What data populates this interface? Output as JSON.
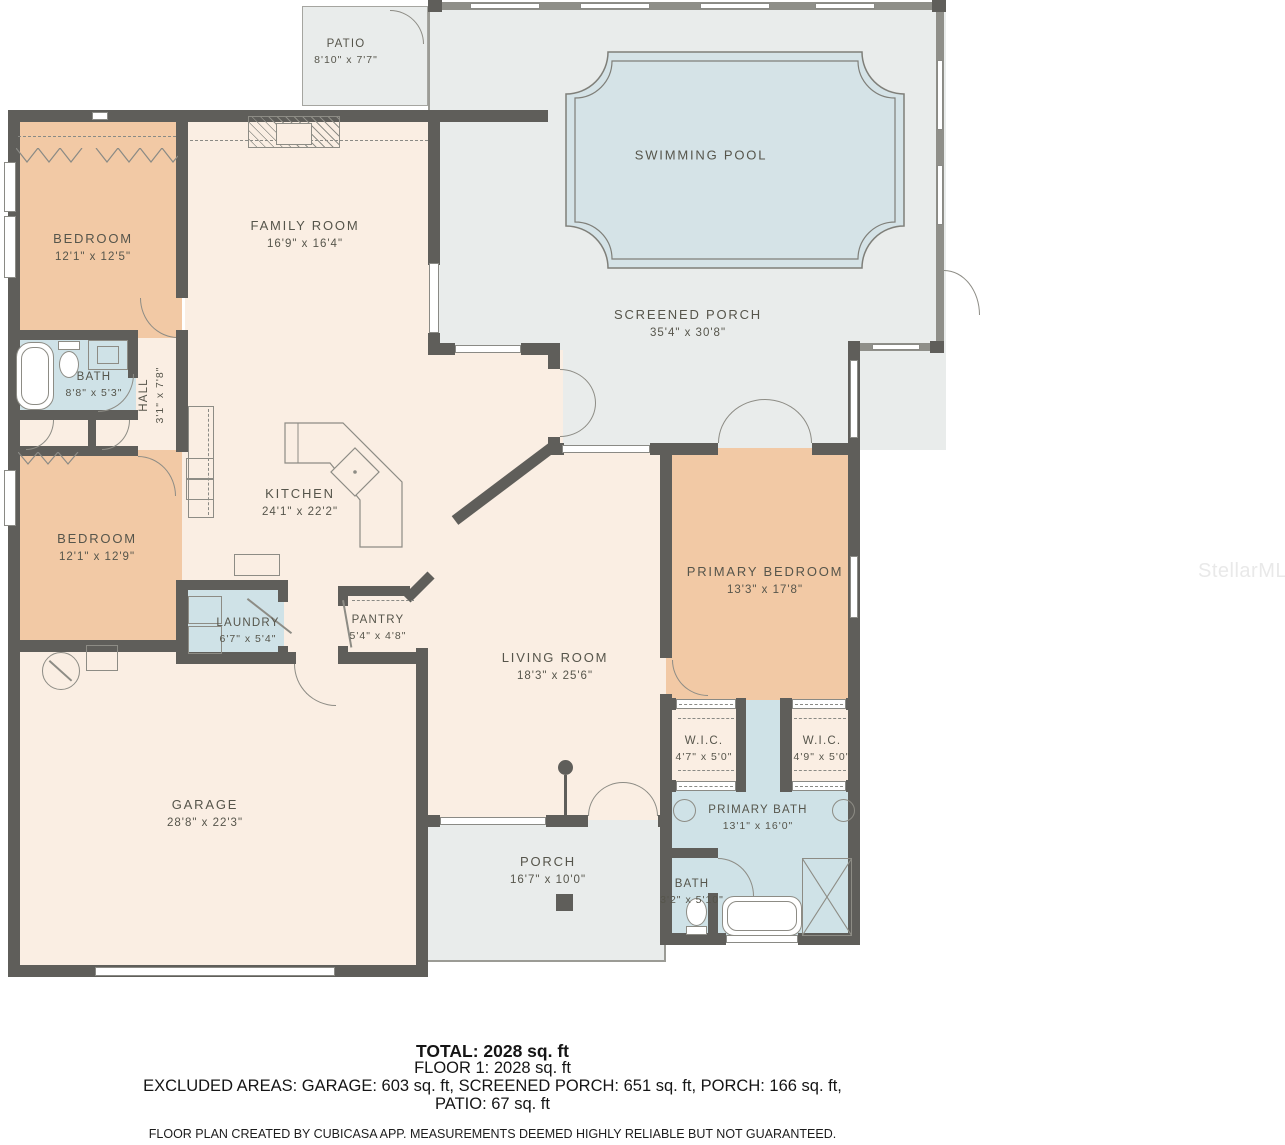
{
  "rooms": {
    "patio": {
      "name": "PATIO",
      "dims": "8'10\" x 7'7\""
    },
    "swimming_pool": {
      "name": "SWIMMING POOL"
    },
    "screened_porch": {
      "name": "SCREENED PORCH",
      "dims": "35'4\" x 30'8\""
    },
    "family_room": {
      "name": "FAMILY ROOM",
      "dims": "16'9\" x 16'4\""
    },
    "bedroom1": {
      "name": "BEDROOM",
      "dims": "12'1\" x 12'5\""
    },
    "bath1": {
      "name": "BATH",
      "dims": "8'8\" x 5'3\""
    },
    "hall": {
      "name": "HALL",
      "dims": "3'1\" x 7'8\""
    },
    "kitchen": {
      "name": "KITCHEN",
      "dims": "24'1\" x 22'2\""
    },
    "bedroom2": {
      "name": "BEDROOM",
      "dims": "12'1\" x 12'9\""
    },
    "laundry": {
      "name": "LAUNDRY",
      "dims": "6'7\" x 5'4\""
    },
    "pantry": {
      "name": "PANTRY",
      "dims": "5'4\" x 4'8\""
    },
    "living_room": {
      "name": "LIVING ROOM",
      "dims": "18'3\" x 25'6\""
    },
    "primary_bedroom": {
      "name": "PRIMARY BEDROOM",
      "dims": "13'3\" x 17'8\""
    },
    "wic_left": {
      "name": "W.I.C.",
      "dims": "4'7\" x 5'0\""
    },
    "wic_right": {
      "name": "W.I.C.",
      "dims": "4'9\" x 5'0\""
    },
    "primary_bath": {
      "name": "PRIMARY BATH",
      "dims": "13'1\" x 16'0\""
    },
    "bath2": {
      "name": "BATH",
      "dims": "3'2\" x 5'10\""
    },
    "garage": {
      "name": "GARAGE",
      "dims": "28'8\" x 22'3\""
    },
    "porch": {
      "name": "PORCH",
      "dims": "16'7\" x 10'0\""
    }
  },
  "summary": {
    "total": "TOTAL: 2028 sq. ft",
    "floor1": "FLOOR 1: 2028 sq. ft",
    "excluded_line1": "EXCLUDED AREAS: GARAGE: 603 sq. ft, SCREENED PORCH: 651 sq. ft, PORCH: 166 sq. ft,",
    "excluded_line2": "PATIO: 67 sq. ft",
    "disclaimer": "FLOOR PLAN CREATED BY CUBICASA APP. MEASUREMENTS DEEMED HIGHLY RELIABLE BUT NOT GUARANTEED."
  },
  "watermark": "StellarMLS",
  "colors": {
    "wall": "#5f5e5a",
    "room_default": "#faeee3",
    "bedroom": "#f2c9a5",
    "wet_room": "#cfe2e7",
    "outdoor": "#e9eceb",
    "pool": "#d5e3e7"
  }
}
